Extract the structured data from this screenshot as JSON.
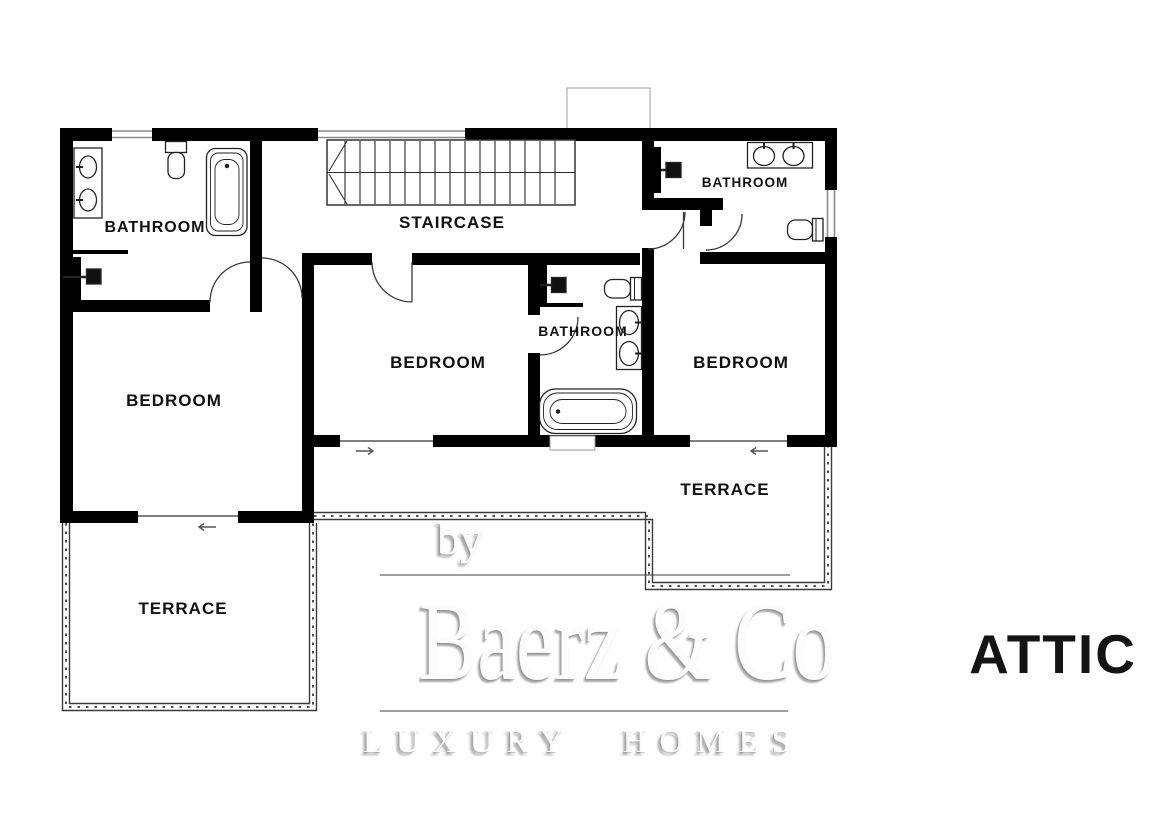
{
  "plan": {
    "floor_label": "ATTIC",
    "areas": [
      {
        "id": "bathroom-left",
        "label": "BATHROOM"
      },
      {
        "id": "staircase",
        "label": "STAIRCASE"
      },
      {
        "id": "bathroom-right",
        "label": "BATHROOM"
      },
      {
        "id": "bathroom-middle",
        "label": "BATHROOM"
      },
      {
        "id": "bedroom-left",
        "label": "BEDROOM"
      },
      {
        "id": "bedroom-middle",
        "label": "BEDROOM"
      },
      {
        "id": "bedroom-right",
        "label": "BEDROOM"
      },
      {
        "id": "terrace-left",
        "label": "TERRACE"
      },
      {
        "id": "terrace-right",
        "label": "TERRACE"
      }
    ],
    "watermark": {
      "prefix": "by",
      "brand": "Baerz & Co",
      "tagline": "LUXURY HOMES"
    },
    "icons": [
      "sink-icon",
      "toilet-icon",
      "bathtub-icon",
      "shower-head-icon",
      "stairs-icon",
      "door-swing-icon",
      "slider-arrow-icon"
    ],
    "colors": {
      "walls": "#000000",
      "fixture_lines": "#222222",
      "railing": "#3a3a3a",
      "watermark_text": "#fcfcfc",
      "watermark_shadow": "#737373",
      "floor_label": "#141414"
    }
  }
}
